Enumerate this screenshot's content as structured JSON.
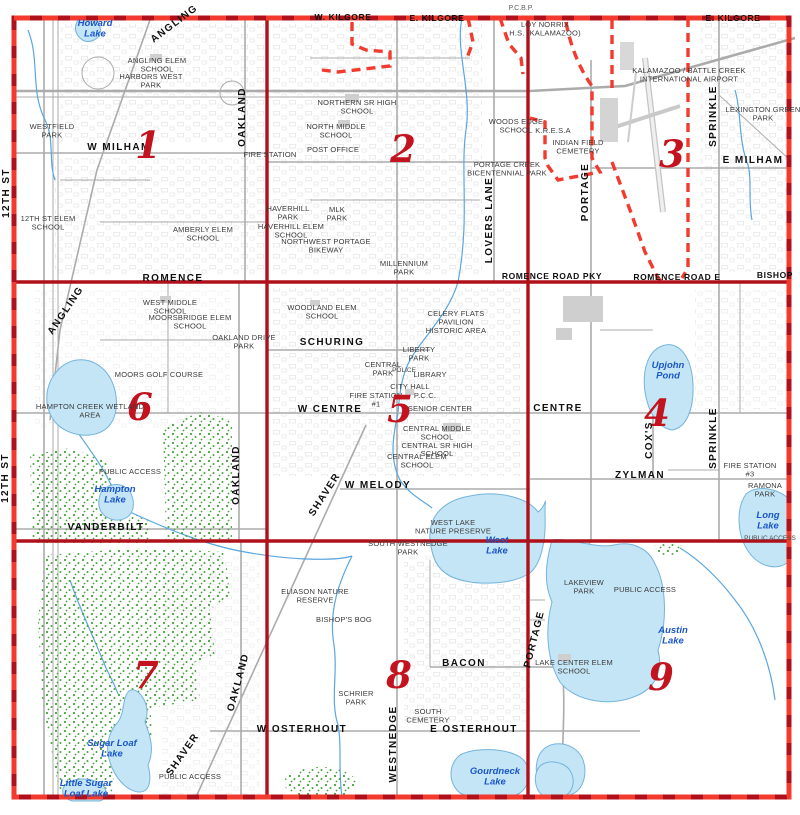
{
  "app": {
    "title": "Portage street map index grid"
  },
  "colors": {
    "grid_red": "#b0101a",
    "dash_red": "#f23b2e",
    "section_number_red": "#c2131f",
    "lake_fill": "#c3e5f5",
    "lake_edge": "#74b4dc",
    "lake_label_blue": "#1a56c8",
    "vegetation_green": "#46a33c",
    "road_gray": "#adadad",
    "creek_blue": "#5aa6e0"
  },
  "map": {
    "labels": [
      {
        "id": "label-w-kilgore",
        "cls": "roadsm",
        "text": "W. KILGORE",
        "x": 343,
        "y": 20
      },
      {
        "id": "label-e-kilgore-mid",
        "cls": "roadsm",
        "text": "E. KILGORE",
        "x": 437,
        "y": 21
      },
      {
        "id": "label-pcbp",
        "cls": "edge",
        "text": "P.C.B.P.",
        "x": 521,
        "y": 10
      },
      {
        "id": "label-e-kilgore",
        "cls": "roadsm",
        "text": "E. KILGORE",
        "x": 733,
        "y": 21
      },
      {
        "id": "label-loy-norrix",
        "cls": "place",
        "text": "LOY NORRIX\nH.S. (KALAMAZOO)",
        "x": 545,
        "y": 27
      },
      {
        "id": "lake-label-howard",
        "cls": "lake",
        "text": "Howard\nLake",
        "x": 95,
        "y": 26
      },
      {
        "id": "road-label-angling-1",
        "cls": "road",
        "text": "ANGLING",
        "x": 176,
        "y": 26,
        "rot": -37
      },
      {
        "id": "place-angling-elem",
        "cls": "place",
        "text": "ANGLING ELEM\nSCHOOL",
        "x": 157,
        "y": 63
      },
      {
        "id": "place-harbors-west-park",
        "cls": "place",
        "text": "HARBORS WEST\nPARK",
        "x": 151,
        "y": 79
      },
      {
        "id": "place-westfield-park",
        "cls": "place",
        "text": "WESTFIELD\nPARK",
        "x": 52,
        "y": 129
      },
      {
        "id": "road-label-w-milham",
        "cls": "road",
        "text": "W  MILHAM",
        "x": 119,
        "y": 150
      },
      {
        "id": "section-number-1",
        "cls": "num",
        "text": "1",
        "x": 148,
        "y": 158
      },
      {
        "id": "road-label-oakland-1",
        "cls": "road",
        "text": "OAKLAND",
        "x": 245,
        "y": 117,
        "rot": -90
      },
      {
        "id": "road-label-12th-st-1",
        "cls": "road",
        "text": "12TH ST",
        "x": 9,
        "y": 193,
        "rot": -90
      },
      {
        "id": "place-12th-st-elem",
        "cls": "place",
        "text": "12TH ST ELEM\nSCHOOL",
        "x": 48,
        "y": 221
      },
      {
        "id": "place-amberly-elem",
        "cls": "place",
        "text": "AMBERLY ELEM\nSCHOOL",
        "x": 203,
        "y": 232
      },
      {
        "id": "place-fire-station-border",
        "cls": "place",
        "text": "FIRE STATION",
        "x": 270,
        "y": 157
      },
      {
        "id": "place-post-office",
        "cls": "place",
        "text": "POST OFFICE",
        "x": 333,
        "y": 152
      },
      {
        "id": "place-northern-sr-high",
        "cls": "place",
        "text": "NORTHERN SR HIGH\nSCHOOL",
        "x": 357,
        "y": 105
      },
      {
        "id": "place-north-middle",
        "cls": "place",
        "text": "NORTH MIDDLE\nSCHOOL",
        "x": 336,
        "y": 129
      },
      {
        "id": "section-number-2",
        "cls": "num",
        "text": "2",
        "x": 403,
        "y": 162
      },
      {
        "id": "place-mlk-park",
        "cls": "place",
        "text": "MLK\nPARK",
        "x": 337,
        "y": 212
      },
      {
        "id": "place-haverhill-park",
        "cls": "place",
        "text": "HAVERHILL\nPARK",
        "x": 288,
        "y": 211
      },
      {
        "id": "place-haverhill-elem",
        "cls": "place",
        "text": "HAVERHILL ELEM\nSCHOOL",
        "x": 291,
        "y": 229
      },
      {
        "id": "place-nw-portage-bikeway",
        "cls": "place",
        "text": "NORTHWEST PORTAGE\nBIKEWAY",
        "x": 326,
        "y": 244
      },
      {
        "id": "place-millennium-park",
        "cls": "place",
        "text": "MILLENNIUM\nPARK",
        "x": 404,
        "y": 266
      },
      {
        "id": "road-label-lovers-lane",
        "cls": "road",
        "text": "LOVERS LANE",
        "x": 492,
        "y": 220,
        "rot": -90
      },
      {
        "id": "place-portage-creek-bicentennial",
        "cls": "place",
        "text": "PORTAGE CREEK\nBICENTENNIAL PARK",
        "x": 507,
        "y": 167
      },
      {
        "id": "place-woods-edge",
        "cls": "place",
        "text": "WOODS EDGE\nSCHOOL",
        "x": 516,
        "y": 124
      },
      {
        "id": "place-airport",
        "cls": "place",
        "text": "KALAMAZOO / BATTLE CREEK\nINTERNATIONAL AIRPORT",
        "x": 689,
        "y": 73
      },
      {
        "id": "place-kresa",
        "cls": "place",
        "text": "K.R.E.S.A",
        "x": 553,
        "y": 133
      },
      {
        "id": "place-indian-field-cemetery",
        "cls": "place",
        "text": "INDIAN FIELD\nCEMETERY",
        "x": 578,
        "y": 145
      },
      {
        "id": "road-label-sprinkle-3",
        "cls": "road",
        "text": "SPRINKLE",
        "x": 716,
        "y": 116,
        "rot": -90
      },
      {
        "id": "place-lexington-green-park",
        "cls": "place",
        "text": "LEXINGTON GREEN\nPARK",
        "x": 763,
        "y": 112
      },
      {
        "id": "road-label-e-milham",
        "cls": "road",
        "text": "E MILHAM",
        "x": 753,
        "y": 163
      },
      {
        "id": "road-label-portage-3",
        "cls": "road",
        "text": "PORTAGE",
        "x": 588,
        "y": 192,
        "rot": -90
      },
      {
        "id": "section-number-3",
        "cls": "num",
        "text": "3",
        "x": 672,
        "y": 167
      },
      {
        "id": "road-label-romence",
        "cls": "road",
        "text": "ROMENCE",
        "x": 173,
        "y": 281
      },
      {
        "id": "road-label-romence-road-pky",
        "cls": "roadsm",
        "text": "ROMENCE ROAD PKY",
        "x": 552,
        "y": 279
      },
      {
        "id": "road-label-romence-road-e",
        "cls": "roadsm",
        "text": "ROMENCE ROAD E",
        "x": 677,
        "y": 280
      },
      {
        "id": "road-label-bishop",
        "cls": "roadsm",
        "text": "BISHOP",
        "x": 775,
        "y": 278
      },
      {
        "id": "road-label-angling-6",
        "cls": "road",
        "text": "ANGLING",
        "x": 68,
        "y": 312,
        "rot": -56
      },
      {
        "id": "place-west-middle",
        "cls": "place",
        "text": "WEST MIDDLE\nSCHOOL",
        "x": 170,
        "y": 305
      },
      {
        "id": "place-moorsbridge-elem",
        "cls": "place",
        "text": "MOORSBRIDGE ELEM\nSCHOOL",
        "x": 190,
        "y": 320
      },
      {
        "id": "place-oakland-drive-park",
        "cls": "place",
        "text": "OAKLAND DRIVE\nPARK",
        "x": 244,
        "y": 340
      },
      {
        "id": "place-moors-golf",
        "cls": "place",
        "text": "MOORS GOLF COURSE",
        "x": 159,
        "y": 377
      },
      {
        "id": "section-number-6",
        "cls": "num",
        "text": "6",
        "x": 140,
        "y": 420
      },
      {
        "id": "place-hampton-creek-wetland",
        "cls": "place",
        "text": "HAMPTON CREEK WETLAND\nAREA",
        "x": 90,
        "y": 409
      },
      {
        "id": "place-public-access-6",
        "cls": "place",
        "text": "PUBLIC ACCESS",
        "x": 130,
        "y": 474
      },
      {
        "id": "lake-label-hampton",
        "cls": "lake",
        "text": "Hampton\nLake",
        "x": 115,
        "y": 492
      },
      {
        "id": "road-label-vanderbilt",
        "cls": "road",
        "text": "VANDERBILT",
        "x": 106,
        "y": 530
      },
      {
        "id": "road-label-oakland-6",
        "cls": "road",
        "text": "OAKLAND",
        "x": 239,
        "y": 475,
        "rot": -90
      },
      {
        "id": "road-label-12th-st-6",
        "cls": "road",
        "text": "12TH ST",
        "x": 8,
        "y": 478,
        "rot": -90
      },
      {
        "id": "place-woodland-elem",
        "cls": "place",
        "text": "WOODLAND ELEM\nSCHOOL",
        "x": 322,
        "y": 310
      },
      {
        "id": "road-label-schuring",
        "cls": "road",
        "text": "SCHURING",
        "x": 332,
        "y": 345
      },
      {
        "id": "place-celery-flats",
        "cls": "place",
        "text": "CELERY FLATS\nPAVILION\nHISTORIC AREA",
        "x": 456,
        "y": 316
      },
      {
        "id": "place-liberty-park",
        "cls": "place",
        "text": "LIBERTY\nPARK",
        "x": 419,
        "y": 352
      },
      {
        "id": "place-central-park",
        "cls": "place",
        "text": "CENTRAL\nPARK",
        "x": 383,
        "y": 367
      },
      {
        "id": "place-police",
        "cls": "placesm",
        "text": "POLICE",
        "x": 404,
        "y": 372
      },
      {
        "id": "place-library",
        "cls": "place",
        "text": "LIBRARY",
        "x": 430,
        "y": 377
      },
      {
        "id": "place-city-hall",
        "cls": "place",
        "text": "CITY HALL",
        "x": 410,
        "y": 389
      },
      {
        "id": "place-pcc",
        "cls": "place",
        "text": "P.C.C.",
        "x": 425,
        "y": 398
      },
      {
        "id": "place-fire-station-1",
        "cls": "place",
        "text": "FIRE STATION\n#1",
        "x": 376,
        "y": 398
      },
      {
        "id": "road-label-w-centre",
        "cls": "road",
        "text": "W  CENTRE",
        "x": 330,
        "y": 412
      },
      {
        "id": "section-number-5",
        "cls": "num",
        "text": "5",
        "x": 400,
        "y": 422
      },
      {
        "id": "place-senior-center",
        "cls": "place",
        "text": "SENIOR CENTER",
        "x": 440,
        "y": 411
      },
      {
        "id": "place-central-middle",
        "cls": "place",
        "text": "CENTRAL MIDDLE\nSCHOOL\nCENTRAL SR HIGH\nSCHOOL",
        "x": 437,
        "y": 431
      },
      {
        "id": "place-central-elem",
        "cls": "place",
        "text": "CENTRAL ELEM\nSCHOOL",
        "x": 417,
        "y": 459
      },
      {
        "id": "road-label-shaver-5",
        "cls": "road",
        "text": "SHAVER",
        "x": 327,
        "y": 496,
        "rot": -57
      },
      {
        "id": "road-label-w-melody",
        "cls": "road",
        "text": "W  MELODY",
        "x": 378,
        "y": 488
      },
      {
        "id": "place-west-lake-preserve",
        "cls": "place",
        "text": "WEST LAKE\nNATURE PRESERVE",
        "x": 453,
        "y": 525
      },
      {
        "id": "lake-label-west",
        "cls": "lake",
        "text": "West\nLake",
        "x": 497,
        "y": 543
      },
      {
        "id": "lake-label-upjohn",
        "cls": "lake",
        "text": "Upjohn\nPond",
        "x": 668,
        "y": 368
      },
      {
        "id": "road-label-centre-4",
        "cls": "road",
        "text": "CENTRE",
        "x": 558,
        "y": 411
      },
      {
        "id": "section-number-4",
        "cls": "num",
        "text": "4",
        "x": 657,
        "y": 426
      },
      {
        "id": "road-label-coxs",
        "cls": "road",
        "text": "COX'S",
        "x": 652,
        "y": 440,
        "rot": -90
      },
      {
        "id": "road-label-sprinkle-4",
        "cls": "road",
        "text": "SPRINKLE",
        "x": 716,
        "y": 438,
        "rot": -90
      },
      {
        "id": "road-label-zylman",
        "cls": "road",
        "text": "ZYLMAN",
        "x": 640,
        "y": 478
      },
      {
        "id": "place-fire-station-3",
        "cls": "place",
        "text": "FIRE STATION\n#3",
        "x": 750,
        "y": 468
      },
      {
        "id": "place-ramona-park",
        "cls": "place",
        "text": "RAMONA\nPARK",
        "x": 765,
        "y": 488
      },
      {
        "id": "lake-label-long",
        "cls": "lake",
        "text": "Long\nLake",
        "x": 768,
        "y": 518
      },
      {
        "id": "place-public-access-4",
        "cls": "placesm",
        "text": "PUBLIC ACCESS",
        "x": 770,
        "y": 540
      },
      {
        "id": "section-number-7",
        "cls": "num",
        "text": "7",
        "x": 146,
        "y": 688
      },
      {
        "id": "road-label-oakland-7",
        "cls": "road",
        "text": "OAKLAND",
        "x": 241,
        "y": 683,
        "rot": -75
      },
      {
        "id": "road-label-shaver-7",
        "cls": "road",
        "text": "SHAVER",
        "x": 185,
        "y": 756,
        "rot": -55
      },
      {
        "id": "lake-label-sugar-loaf",
        "cls": "lake",
        "text": "Sugar Loaf\nLake",
        "x": 112,
        "y": 746
      },
      {
        "id": "lake-label-little-sugar-loaf",
        "cls": "lake",
        "text": "Little Sugar\nLoaf Lake",
        "x": 86,
        "y": 786
      },
      {
        "id": "place-public-access-7",
        "cls": "place",
        "text": "PUBLIC ACCESS",
        "x": 190,
        "y": 779
      },
      {
        "id": "place-south-westnedge-park",
        "cls": "place",
        "text": "SOUTH WESTNEDGE\nPARK",
        "x": 408,
        "y": 546
      },
      {
        "id": "place-eliason-nature",
        "cls": "place",
        "text": "ELIASON NATURE\nRESERVE",
        "x": 315,
        "y": 594
      },
      {
        "id": "place-bishops-bog",
        "cls": "place",
        "text": "BISHOP'S BOG",
        "x": 344,
        "y": 622
      },
      {
        "id": "section-number-8",
        "cls": "num",
        "text": "8",
        "x": 399,
        "y": 688
      },
      {
        "id": "road-label-bacon",
        "cls": "road",
        "text": "BACON",
        "x": 464,
        "y": 666
      },
      {
        "id": "place-schrier-park",
        "cls": "place",
        "text": "SCHRIER\nPARK",
        "x": 356,
        "y": 696
      },
      {
        "id": "place-south-cemetery",
        "cls": "place",
        "text": "SOUTH\nCEMETERY",
        "x": 428,
        "y": 714
      },
      {
        "id": "road-label-w-osterhout",
        "cls": "road",
        "text": "W  OSTERHOUT",
        "x": 302,
        "y": 732
      },
      {
        "id": "road-label-e-osterhout",
        "cls": "road",
        "text": "E  OSTERHOUT",
        "x": 474,
        "y": 732
      },
      {
        "id": "road-label-westnedge",
        "cls": "road",
        "text": "WESTNEDGE",
        "x": 396,
        "y": 744,
        "rot": -90
      },
      {
        "id": "lake-label-gourdneck",
        "cls": "lake",
        "text": "Gourdneck\nLake",
        "x": 495,
        "y": 774
      },
      {
        "id": "place-lakeview-park",
        "cls": "place",
        "text": "LAKEVIEW\nPARK",
        "x": 584,
        "y": 585
      },
      {
        "id": "place-public-access-9",
        "cls": "place",
        "text": "PUBLIC ACCESS",
        "x": 645,
        "y": 592
      },
      {
        "id": "lake-label-austin",
        "cls": "lake",
        "text": "Austin\nLake",
        "x": 673,
        "y": 633
      },
      {
        "id": "section-number-9",
        "cls": "num",
        "text": "9",
        "x": 661,
        "y": 690
      },
      {
        "id": "place-lake-center-elem",
        "cls": "place",
        "text": "LAKE CENTER ELEM\nSCHOOL",
        "x": 574,
        "y": 665
      },
      {
        "id": "road-label-portage-9",
        "cls": "road",
        "text": "PORTAGE",
        "x": 537,
        "y": 640,
        "rot": -76
      }
    ]
  }
}
